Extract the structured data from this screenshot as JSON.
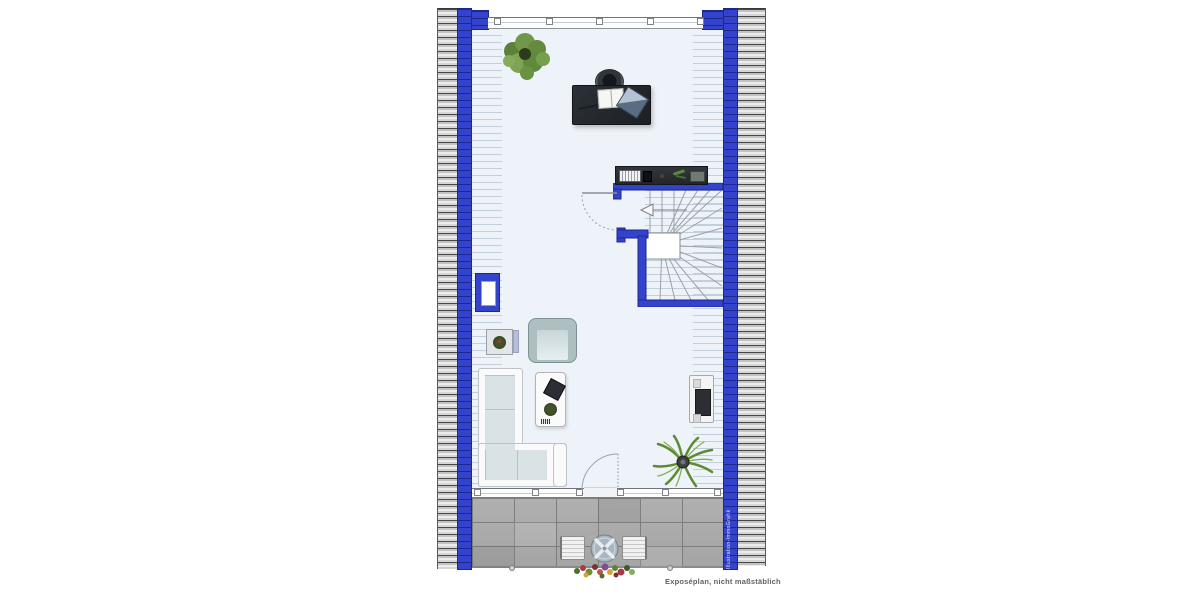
{
  "footer": {
    "label": "Exposéplan, nicht maßstäblich"
  },
  "watermark": {
    "label": "Illustration-ImmoGrafik"
  },
  "colors": {
    "wall_blue": "#3443cb",
    "wall_blue_dark": "#1c2790",
    "hatch_bg": "#d6d6d6",
    "hatch_line": "#474747",
    "floor": "#eef3f9",
    "slope_line": "#9fb0bd",
    "terrace": "#acacac",
    "sofa_cushion": "#d9e3e5",
    "white_furn": "#fafafa",
    "plant_green": "#5d8138"
  }
}
